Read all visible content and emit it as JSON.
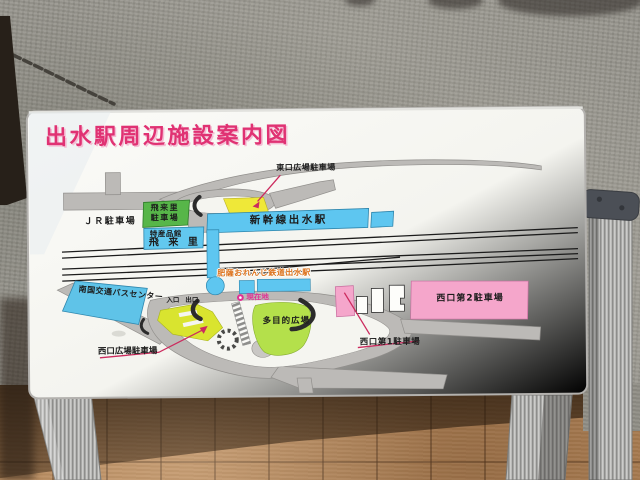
{
  "sign": {
    "title": "出水駅周辺施設案内図",
    "map": {
      "labels": {
        "east_plaza_parking": "東口広場駐車場",
        "jr_parking": "ＪＲ駐車場",
        "hirari_parking_line1": "飛来里",
        "hirari_parking_line2": "駐車場",
        "tokusan_hall_line1": "特産品館",
        "tokusan_hall_line2": "飛 来 里",
        "shinkansen_station": "新幹線出水駅",
        "orange_railway_station": "肥薩おれんじ鉄道出水駅",
        "current_location": "現在地",
        "bus_center": "南国交通バスセンター",
        "entrance": "入口",
        "exit": "出口",
        "west_plaza_parking": "西口広場駐車場",
        "multipurpose_plaza": "多目的広場",
        "west_no1_parking": "西口第1駐車場",
        "west_no2_parking": "西口第2駐車場"
      },
      "colors": {
        "title_pink": "#e03273",
        "facility_blue": "#5ec6f0",
        "parking_green": "#57b649",
        "parking_yellow": "#efe838",
        "parking_chartreuse": "#d9e42f",
        "plaza_lime": "#b4e04b",
        "parking_pink": "#f5a6cb",
        "road_gray": "#bcbab7",
        "railway_black": "#1c1c1c",
        "annotation_red": "#cc2b5e",
        "orange_text": "#dd7420",
        "current_location_magenta": "#e03294"
      }
    }
  }
}
